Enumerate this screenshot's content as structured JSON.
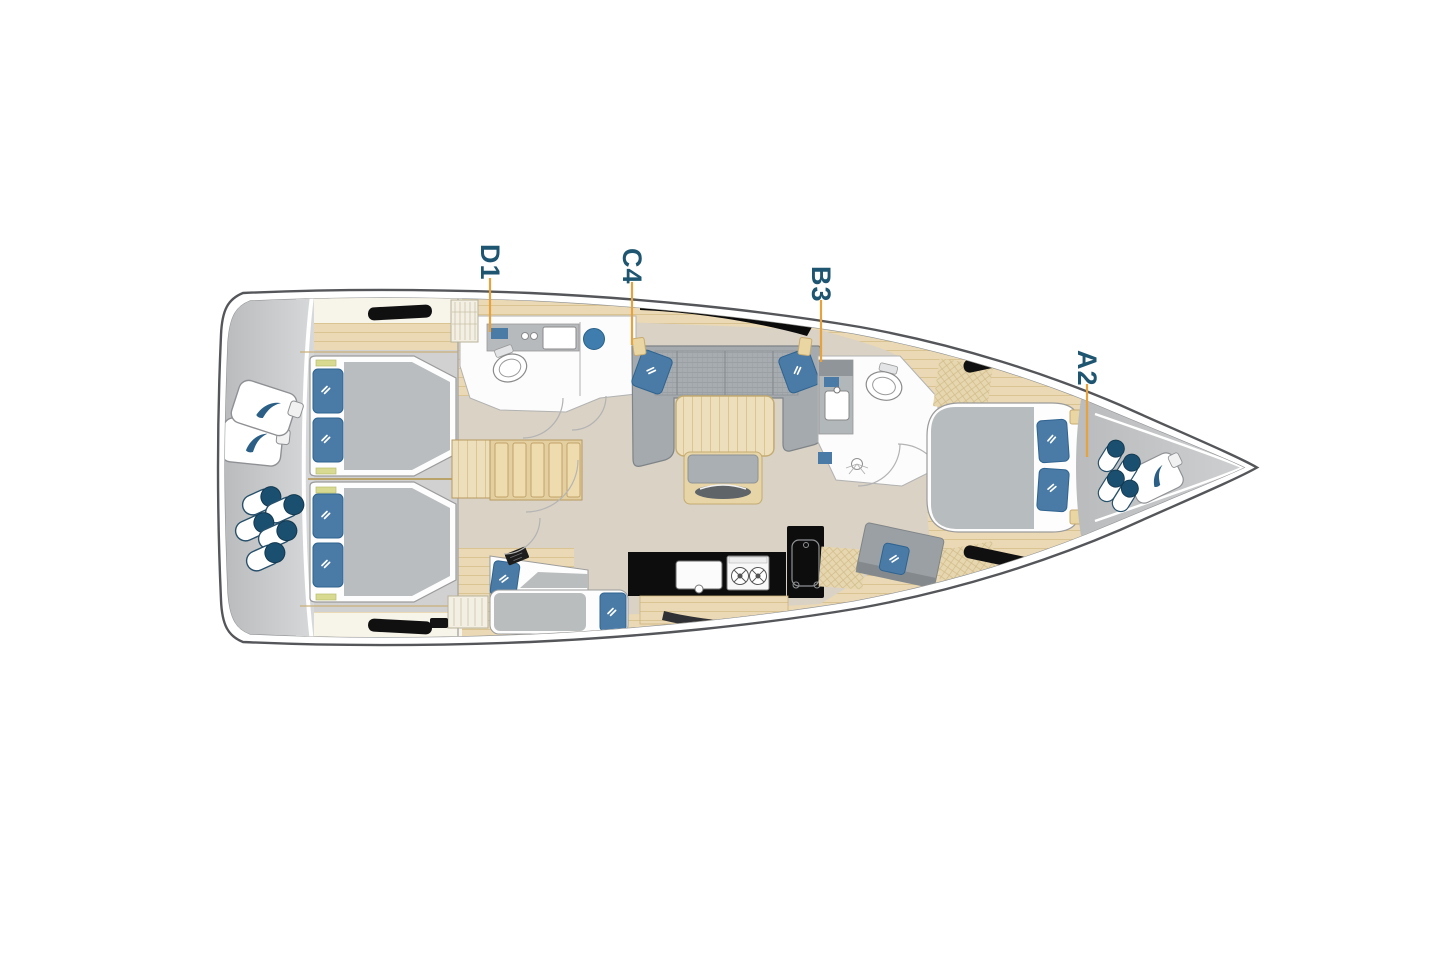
{
  "diagram": {
    "type": "sailing-yacht-interior-floor-plan",
    "orientation": "bow-right",
    "cabin_markers": [
      {
        "id": "D1"
      },
      {
        "id": "C4"
      },
      {
        "id": "B3"
      },
      {
        "id": "A2"
      }
    ],
    "marker_style": {
      "text_color": "#1e5570",
      "leader_line_color": "#e8a23c"
    },
    "colors": {
      "hull_outline": "#54565a",
      "inner_hull_line": "#8f9194",
      "deck_gray": "#c2c4c6",
      "interior_wood": "#ead9b4",
      "floor_beige": "#d9d2c5",
      "cabin_floor_gray": "#d2d1d1",
      "room_white": "#fcfcfc",
      "sofa_gray": "#a4aaad",
      "mattress_gray": "#b9bdbf",
      "pillow_blue": "#4a7ba6",
      "counter_black": "#0d0d0e",
      "fender_navy": "#1b4f70",
      "hatch_black": "#101010"
    },
    "areas": [
      {
        "name": "stern-deck"
      },
      {
        "name": "aft-cabin-port"
      },
      {
        "name": "aft-cabin-starboard"
      },
      {
        "name": "companionway-stairs"
      },
      {
        "name": "aft-head"
      },
      {
        "name": "berth-cabin"
      },
      {
        "name": "salon"
      },
      {
        "name": "galley"
      },
      {
        "name": "forward-head"
      },
      {
        "name": "owner-cabin-forward"
      },
      {
        "name": "bow-deck"
      }
    ],
    "icons": [
      {
        "name": "fender-cluster-stern"
      },
      {
        "name": "sail-bags-stern"
      },
      {
        "name": "fender-cluster-bow"
      },
      {
        "name": "sail-bag-bow"
      },
      {
        "name": "toilet"
      },
      {
        "name": "sink"
      },
      {
        "name": "stove-burners"
      },
      {
        "name": "shower-head"
      }
    ]
  }
}
